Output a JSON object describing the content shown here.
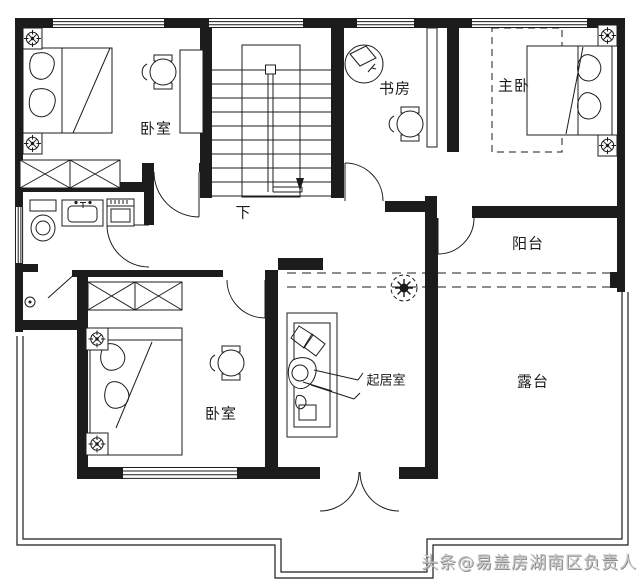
{
  "plan": {
    "rooms": [
      {
        "id": "bedroom-top-left",
        "label": "卧室"
      },
      {
        "id": "study",
        "label": "书房"
      },
      {
        "id": "master-bedroom",
        "label": "主卧"
      },
      {
        "id": "balcony",
        "label": "阳台"
      },
      {
        "id": "bedroom-bottom-left",
        "label": "卧室"
      },
      {
        "id": "living-room",
        "label": "起居室"
      },
      {
        "id": "terrace",
        "label": "露台"
      }
    ],
    "stairs": {
      "down_label": "下"
    },
    "watermark": {
      "text": "头条@易盖房湖南区负责人"
    },
    "colors": {
      "line": "#1c1c1c",
      "background": "#ffffff",
      "watermark": "#c7c7c7"
    },
    "fixtures": [
      "double-bed",
      "bedside-lamp",
      "wardrobe",
      "round-table",
      "desk",
      "office-chair",
      "bookshelf",
      "toilet",
      "sink",
      "washing-machine",
      "sofa",
      "person-figure",
      "potted-plant",
      "ceiling-lamp",
      "stair-down-arrow",
      "door-swing",
      "window",
      "railing"
    ]
  }
}
